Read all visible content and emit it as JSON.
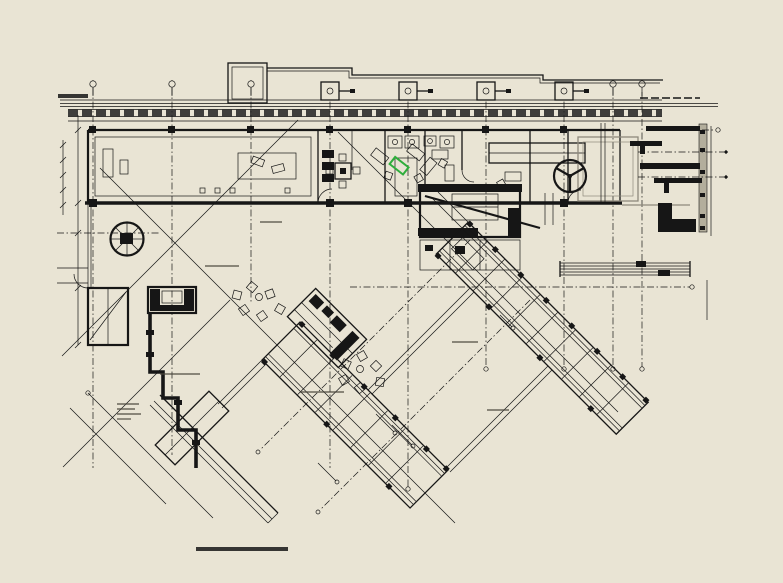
{
  "page": {
    "title": "TLORIS - pritličje",
    "background_color": "#e9e4d4"
  },
  "drawing": {
    "ink_color": "#161616",
    "muted_color": "#8e897c",
    "dimension_band_color": "#b3ae9c",
    "highlight_color": "#2fae3c",
    "icons": {
      "grid_marker": "small circle on dash-dot axis line",
      "boxed_grid_marker": "square with inner circle and side tick",
      "revolving_door": "circle with three spokes",
      "spiral_staircase": "circle with radial spokes",
      "staircase": "rectangle with parallel tread lines",
      "escalator": "rotated rectangle with dense tread lines",
      "column": "small solid black square",
      "chair": "small rotated open square",
      "highlight_marker": "green rotated rectangle"
    }
  }
}
